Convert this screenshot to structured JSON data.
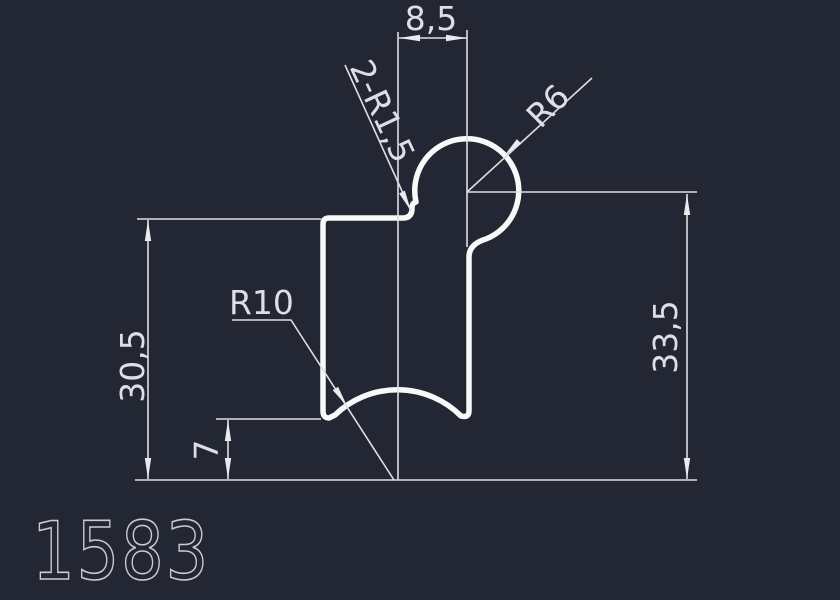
{
  "drawing": {
    "part_number": "1583",
    "dimensions": {
      "top_width": "8,5",
      "corner_fillets": "2-R1,5",
      "head_radius": "R6",
      "groove_radius": "R10",
      "left_height": "30,5",
      "right_height": "33,5",
      "bottom_offset": "7"
    },
    "colors": {
      "background": "#232733",
      "profile_outline": "#f8f9f9",
      "dimension_lines": "#dcdfe3",
      "part_number_text": "#c9cdd2"
    }
  }
}
